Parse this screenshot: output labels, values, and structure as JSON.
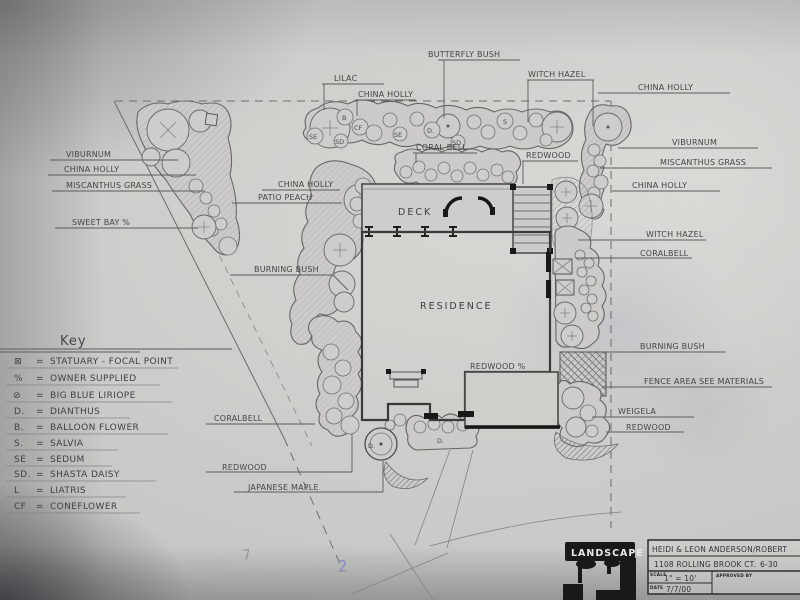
{
  "plan": {
    "area_labels": {
      "deck": "DECK",
      "residence": "RESIDENCE",
      "redwood_patio": "REDWOOD %"
    },
    "plant_labels": {
      "butterfly_bush": "BUTTERFLY BUSH",
      "lilac": "LILAC",
      "china_holly_top": "CHINA HOLLY",
      "witch_hazel_top": "WITCH HAZEL",
      "china_holly_top_right": "CHINA HOLLY",
      "viburnum_right": "VIBURNUM",
      "miscanthus_right": "MISCANTHUS GRASS",
      "china_holly_right": "CHINA HOLLY",
      "viburnum_left": "VIBURNUM",
      "china_holly_left": "CHINA HOLLY",
      "miscanthus_left": "MISCANTHUS GRASS",
      "sweet_bay": "SWEET BAY %",
      "china_holly_house": "CHINA HOLLY",
      "patio_peach": "PATIO PEACH",
      "coral_bell_top": "CORAL BELL",
      "redwood_top": "REDWOOD",
      "witch_hazel_right": "WITCH HAZEL",
      "coralbell_right": "CORALBELL",
      "burning_bush_left": "BURNING BUSH",
      "burning_bush_right": "BURNING BUSH",
      "fence_area": "FENCE AREA SEE MATERIALS",
      "weigela": "WEIGELA",
      "redwood_right": "REDWOOD",
      "coralbell_lower": "CORALBELL",
      "redwood_lower": "REDWOOD",
      "japanese_maple": "JAPANESE MAPLE"
    },
    "bed_letters": [
      "B",
      "CF",
      "SD",
      "SE",
      "SE",
      "D.",
      "SD",
      "S",
      "D.",
      "D."
    ]
  },
  "key": {
    "title": "Key",
    "equals": "=",
    "items": [
      {
        "sym": "⊠",
        "label": "STATUARY - FOCAL POINT"
      },
      {
        "sym": "%",
        "label": "OWNER SUPPLIED"
      },
      {
        "sym": "⊘",
        "label": "BIG BLUE LIRIOPE"
      },
      {
        "sym": "D.",
        "label": "DIANTHUS"
      },
      {
        "sym": "B.",
        "label": "BALLOON FLOWER"
      },
      {
        "sym": "S.",
        "label": "SALVIA"
      },
      {
        "sym": "SE",
        "label": "SEDUM"
      },
      {
        "sym": "SD.",
        "label": "SHASTA DAISY"
      },
      {
        "sym": "L",
        "label": "LIATRIS"
      },
      {
        "sym": "CF",
        "label": "CONEFLOWER"
      }
    ]
  },
  "title_block": {
    "logo_text": "LANDSCAPE",
    "client_line1": "HEIDI & LEON ANDERSON/ROBERT",
    "client_line2": "1108 ROLLING BROOK CT.",
    "date_note": "6-30",
    "scale_label": "SCALE",
    "scale_value": "1\" = 10'",
    "approved_label": "APPROVED BY",
    "date_label": "DATE",
    "date_value": "7/7/00"
  },
  "margin_notes": {
    "pencil": "7",
    "blue": "2"
  },
  "colors": {
    "paper": "#cbcbc9",
    "pencil": "#6c6c6a",
    "label_ink": "#45454a",
    "black_ink": "#191919",
    "blue_note": "#7b84c4"
  }
}
